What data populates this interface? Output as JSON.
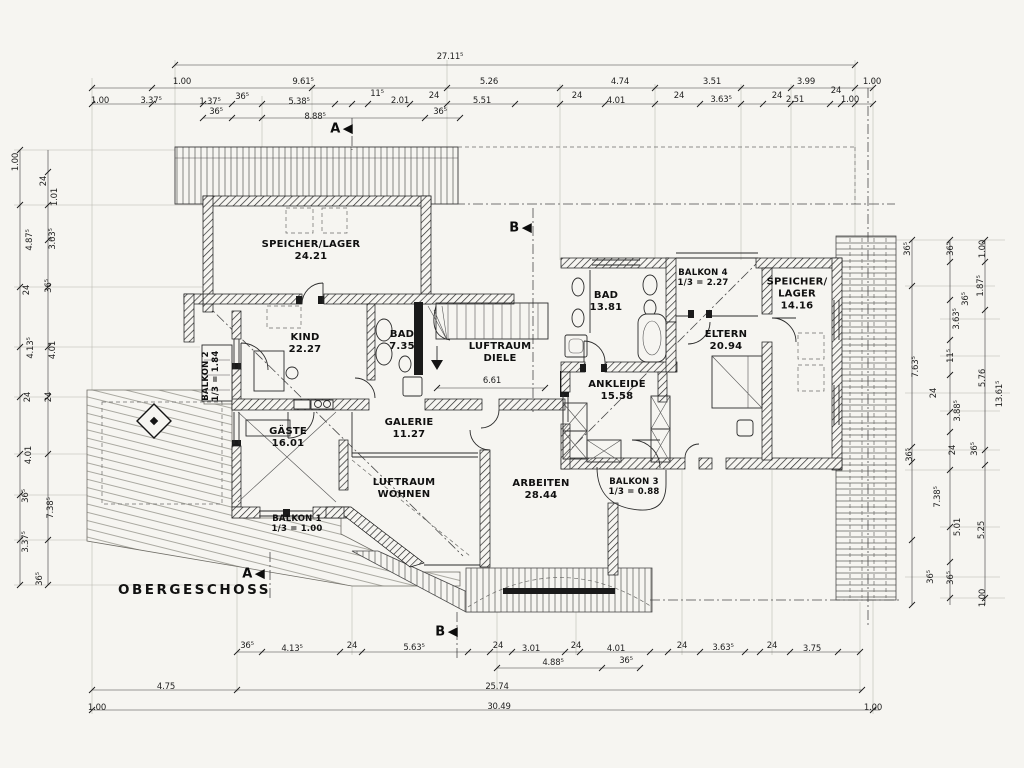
{
  "page": {
    "title": "OBERGESCHOSS"
  },
  "colors": {
    "paper": "#f6f5f1",
    "ink": "#1b1b1b"
  },
  "rooms": [
    {
      "lines": [
        "SPEICHER/LAGER",
        "24.21"
      ],
      "x": 311,
      "y": 251
    },
    {
      "lines": [
        "KIND",
        "22.27"
      ],
      "x": 305,
      "y": 344
    },
    {
      "lines": [
        "BAD",
        "7.35"
      ],
      "x": 402,
      "y": 341
    },
    {
      "lines": [
        "LUFTRAUM",
        "DIELE"
      ],
      "x": 500,
      "y": 353
    },
    {
      "lines": [
        "GÄSTE",
        "16.01"
      ],
      "x": 288,
      "y": 438
    },
    {
      "lines": [
        "GALERIE",
        "11.27"
      ],
      "x": 409,
      "y": 429
    },
    {
      "lines": [
        "LUFTRAUM",
        "WOHNEN"
      ],
      "x": 404,
      "y": 489
    },
    {
      "lines": [
        "ARBEITEN",
        "28.44"
      ],
      "x": 541,
      "y": 490
    },
    {
      "lines": [
        "ANKLEIDE",
        "15.58"
      ],
      "x": 617,
      "y": 391
    },
    {
      "lines": [
        "ELTERN",
        "20.94"
      ],
      "x": 726,
      "y": 341
    },
    {
      "lines": [
        "BAD",
        "13.81"
      ],
      "x": 606,
      "y": 302
    },
    {
      "lines": [
        "SPEICHER/",
        "LAGER",
        "14.16"
      ],
      "x": 797,
      "y": 294
    },
    {
      "lines": [
        "BALKON 1",
        "1/3 = 1.00"
      ],
      "x": 297,
      "y": 524,
      "s": "sm"
    },
    {
      "lines": [
        "BALKON 2",
        "1/3 = 1.84"
      ],
      "x": 211,
      "y": 376,
      "s": "sm",
      "rot": true
    },
    {
      "lines": [
        "BALKON 3",
        "1/3 = 0.88"
      ],
      "x": 634,
      "y": 487,
      "s": "sm"
    },
    {
      "lines": [
        "BALKON 4",
        "1/3 = 2.27"
      ],
      "x": 703,
      "y": 278,
      "s": "sm"
    }
  ],
  "dimensions": {
    "top": [
      {
        "t": "27.11⁵",
        "x": 450,
        "y": 57
      },
      {
        "t": "1.00",
        "x": 182,
        "y": 82
      },
      {
        "t": "9.61⁵",
        "x": 303,
        "y": 82
      },
      {
        "t": "5.26",
        "x": 489,
        "y": 82
      },
      {
        "t": "4.74",
        "x": 620,
        "y": 82
      },
      {
        "t": "3.51",
        "x": 712,
        "y": 82
      },
      {
        "t": "3.99",
        "x": 806,
        "y": 82
      },
      {
        "t": "1.00",
        "x": 872,
        "y": 82
      },
      {
        "t": "1.00",
        "x": 100,
        "y": 101
      },
      {
        "t": "3.37⁵",
        "x": 151,
        "y": 101
      },
      {
        "t": "1.37⁵",
        "x": 210,
        "y": 102
      },
      {
        "t": "36⁵",
        "x": 242,
        "y": 97
      },
      {
        "t": "5.38⁵",
        "x": 299,
        "y": 102
      },
      {
        "t": "11⁵",
        "x": 377,
        "y": 94
      },
      {
        "t": "2.01",
        "x": 400,
        "y": 101
      },
      {
        "t": "24",
        "x": 434,
        "y": 96
      },
      {
        "t": "5.51",
        "x": 482,
        "y": 101
      },
      {
        "t": "24",
        "x": 577,
        "y": 96
      },
      {
        "t": "4.01",
        "x": 616,
        "y": 101
      },
      {
        "t": "24",
        "x": 679,
        "y": 96
      },
      {
        "t": "3.63⁵",
        "x": 721,
        "y": 100
      },
      {
        "t": "24",
        "x": 777,
        "y": 96
      },
      {
        "t": "2.51",
        "x": 795,
        "y": 100
      },
      {
        "t": "24",
        "x": 836,
        "y": 91
      },
      {
        "t": "1.00",
        "x": 850,
        "y": 100
      },
      {
        "t": "36⁵",
        "x": 216,
        "y": 112
      },
      {
        "t": "8.88⁵",
        "x": 315,
        "y": 117
      },
      {
        "t": "36⁵",
        "x": 440,
        "y": 112
      }
    ],
    "left": [
      {
        "t": "1.00",
        "x": 16,
        "y": 162,
        "rot": true
      },
      {
        "t": "24",
        "x": 44,
        "y": 181,
        "rot": true
      },
      {
        "t": "1.01",
        "x": 55,
        "y": 197,
        "rot": true
      },
      {
        "t": "4.87⁵",
        "x": 30,
        "y": 240,
        "rot": true
      },
      {
        "t": "3.63⁵",
        "x": 53,
        "y": 239,
        "rot": true
      },
      {
        "t": "24",
        "x": 27,
        "y": 290,
        "rot": true
      },
      {
        "t": "36⁵",
        "x": 49,
        "y": 286,
        "rot": true
      },
      {
        "t": "4.13⁵",
        "x": 31,
        "y": 348,
        "rot": true
      },
      {
        "t": "4.01",
        "x": 53,
        "y": 350,
        "rot": true
      },
      {
        "t": "24",
        "x": 28,
        "y": 397,
        "rot": true
      },
      {
        "t": "24",
        "x": 49,
        "y": 397,
        "rot": true
      },
      {
        "t": "4.01",
        "x": 29,
        "y": 455,
        "rot": true
      },
      {
        "t": "36⁵",
        "x": 26,
        "y": 496,
        "rot": true
      },
      {
        "t": "7.38⁵",
        "x": 51,
        "y": 508,
        "rot": true
      },
      {
        "t": "3.37⁵",
        "x": 26,
        "y": 542,
        "rot": true
      },
      {
        "t": "36⁵",
        "x": 40,
        "y": 579,
        "rot": true
      }
    ],
    "right": [
      {
        "t": "36⁵",
        "x": 908,
        "y": 249,
        "rot": true
      },
      {
        "t": "36⁵",
        "x": 951,
        "y": 249,
        "rot": true
      },
      {
        "t": "1.00",
        "x": 983,
        "y": 249,
        "rot": true
      },
      {
        "t": "1.87⁵",
        "x": 981,
        "y": 286,
        "rot": true
      },
      {
        "t": "36⁵",
        "x": 966,
        "y": 299,
        "rot": true
      },
      {
        "t": "3.63⁵",
        "x": 957,
        "y": 319,
        "rot": true
      },
      {
        "t": "11⁵",
        "x": 951,
        "y": 356,
        "rot": true
      },
      {
        "t": "7.63⁵",
        "x": 916,
        "y": 367,
        "rot": true
      },
      {
        "t": "5.76",
        "x": 983,
        "y": 378,
        "rot": true
      },
      {
        "t": "24",
        "x": 934,
        "y": 393,
        "rot": true
      },
      {
        "t": "13.61⁵",
        "x": 1000,
        "y": 394,
        "rot": true
      },
      {
        "t": "3.88⁵",
        "x": 958,
        "y": 411,
        "rot": true
      },
      {
        "t": "24",
        "x": 953,
        "y": 450,
        "rot": true
      },
      {
        "t": "36⁵",
        "x": 910,
        "y": 455,
        "rot": true
      },
      {
        "t": "36⁵",
        "x": 975,
        "y": 449,
        "rot": true
      },
      {
        "t": "7.38⁵",
        "x": 938,
        "y": 497,
        "rot": true
      },
      {
        "t": "5.01",
        "x": 958,
        "y": 527,
        "rot": true
      },
      {
        "t": "5.25",
        "x": 982,
        "y": 530,
        "rot": true
      },
      {
        "t": "36⁵",
        "x": 931,
        "y": 577,
        "rot": true
      },
      {
        "t": "36⁵",
        "x": 951,
        "y": 578,
        "rot": true
      },
      {
        "t": "1.00",
        "x": 983,
        "y": 598,
        "rot": true
      }
    ],
    "bottom": [
      {
        "t": "6.61",
        "x": 492,
        "y": 381
      },
      {
        "t": "36⁵",
        "x": 247,
        "y": 646
      },
      {
        "t": "4.13⁵",
        "x": 292,
        "y": 649
      },
      {
        "t": "24",
        "x": 352,
        "y": 646
      },
      {
        "t": "5.63⁵",
        "x": 414,
        "y": 648
      },
      {
        "t": "24",
        "x": 498,
        "y": 646
      },
      {
        "t": "3.01",
        "x": 531,
        "y": 649
      },
      {
        "t": "24",
        "x": 576,
        "y": 646
      },
      {
        "t": "4.01",
        "x": 616,
        "y": 649
      },
      {
        "t": "24",
        "x": 682,
        "y": 646
      },
      {
        "t": "3.63⁵",
        "x": 723,
        "y": 648
      },
      {
        "t": "24",
        "x": 772,
        "y": 646
      },
      {
        "t": "3.75",
        "x": 812,
        "y": 649
      },
      {
        "t": "4.88⁵",
        "x": 553,
        "y": 663
      },
      {
        "t": "36⁵",
        "x": 626,
        "y": 661
      },
      {
        "t": "4.75",
        "x": 166,
        "y": 687
      },
      {
        "t": "25.74",
        "x": 497,
        "y": 687
      },
      {
        "t": "1.00",
        "x": 97,
        "y": 708
      },
      {
        "t": "30.49",
        "x": 499,
        "y": 707
      },
      {
        "t": "1.00",
        "x": 873,
        "y": 708
      }
    ]
  },
  "markers": [
    {
      "label": "A",
      "x": 341,
      "y": 129
    },
    {
      "label": "B",
      "x": 520,
      "y": 228
    },
    {
      "label": "A",
      "x": 253,
      "y": 574
    },
    {
      "label": "B",
      "x": 446,
      "y": 632
    }
  ]
}
